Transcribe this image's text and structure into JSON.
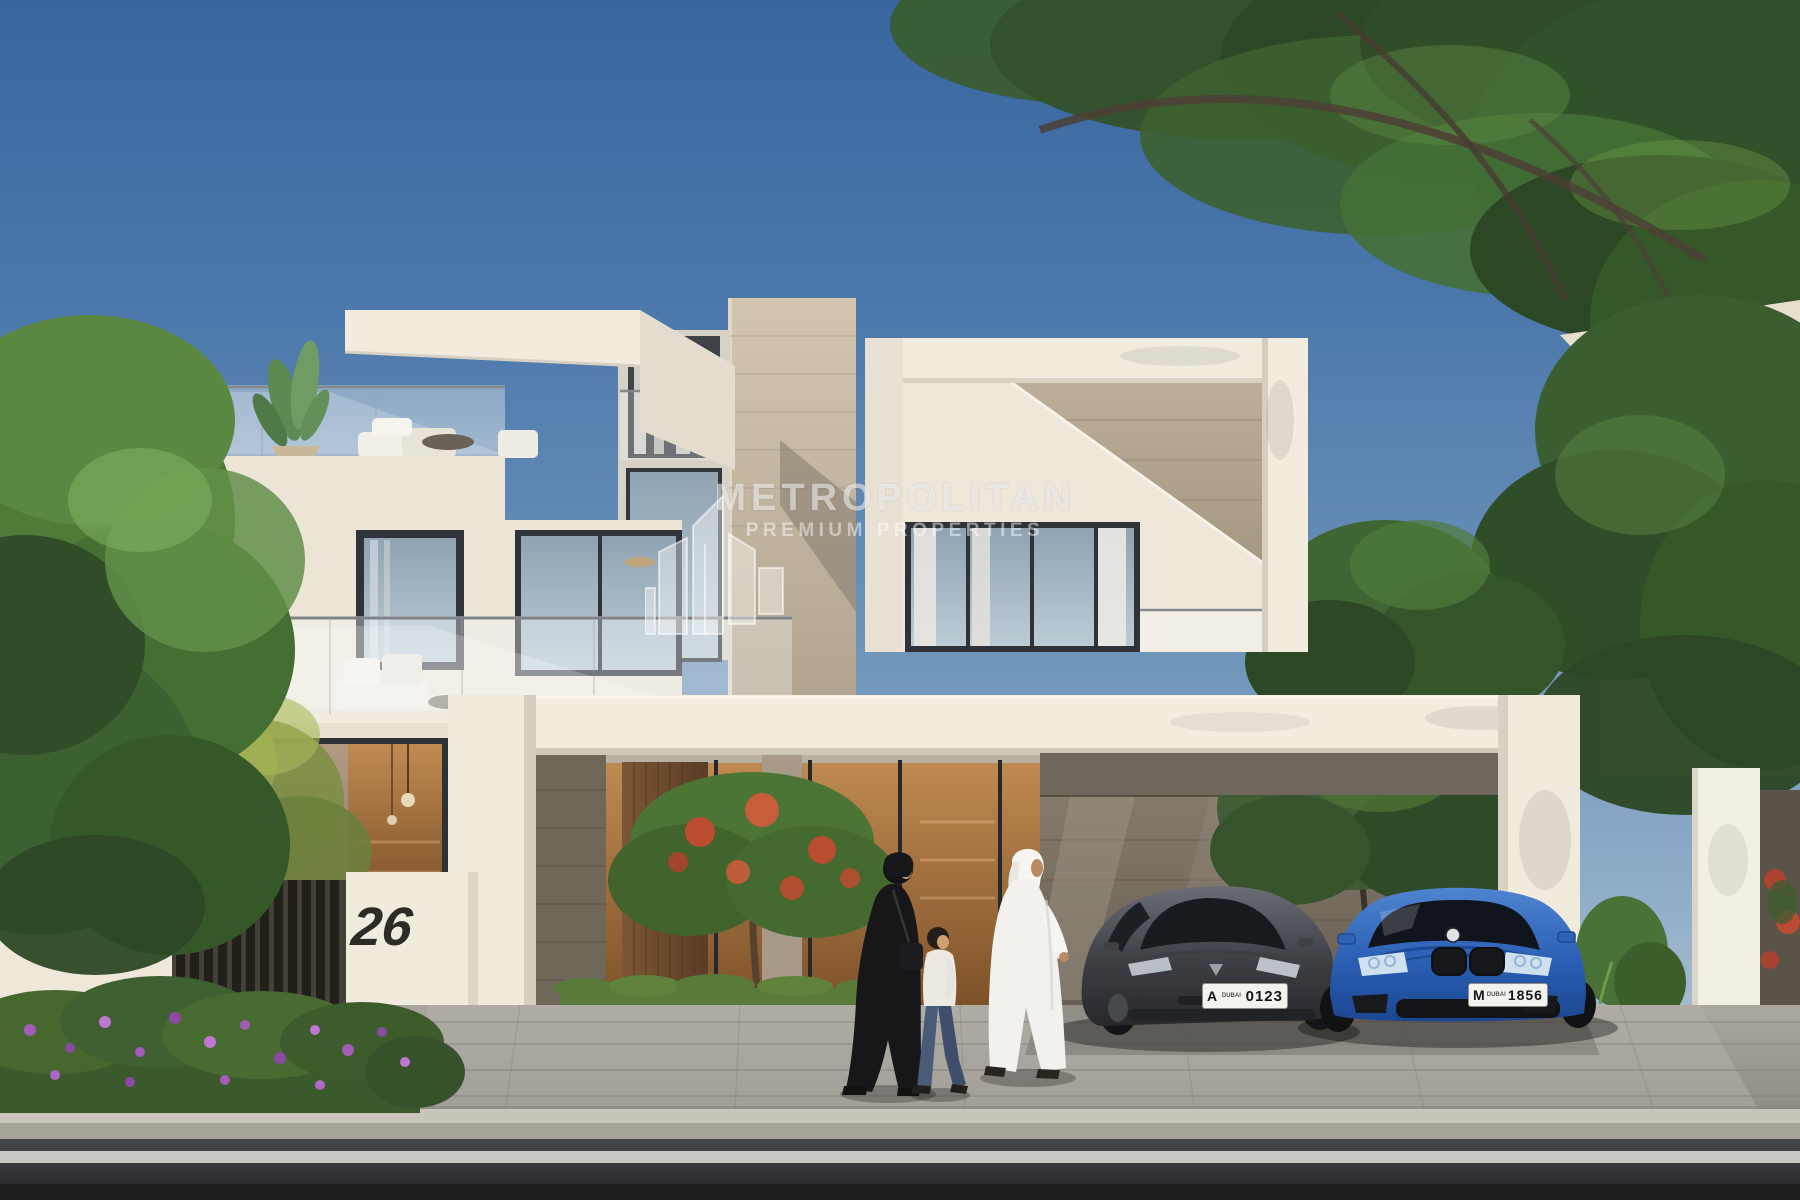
{
  "scene": {
    "description": "Daytime architectural rendering of a modern two-storey white villa with carport, seen from the street",
    "people": {
      "woman": "woman in black abaya with shoulder bag",
      "child": "boy in white shirt and blue jeans",
      "man": "man in white kandura and ghutra"
    }
  },
  "watermark": {
    "title": "METROPOLITAN",
    "subtitle": "PREMIUM PROPERTIES",
    "logo": "metropolitan-buildings-logo-icon"
  },
  "property": {
    "house_number": "26"
  },
  "vehicles": {
    "sedan_grey": {
      "label": "grey sedan",
      "plate_letter": "A",
      "plate_city": "DUBAI",
      "plate_number": "0123",
      "body_color": "#44464c"
    },
    "coupe_blue": {
      "label": "blue coupe",
      "plate_letter": "M",
      "plate_city": "DUBAI",
      "plate_number": "1856",
      "body_color": "#2e63b5"
    }
  },
  "colors": {
    "sky_top": "#39669f",
    "sky_horizon": "#b3c5d3",
    "villa_white_sunlit": "#f2ecdf",
    "villa_white_shade": "#cfc8ba",
    "travertine_stone": "#c4b7a1",
    "dark_stone_cladding": "#6f675a",
    "foliage_dark": "#2f4d27",
    "foliage_light": "#5f8a42",
    "flower_purple": "#a35cb8",
    "flower_red": "#c64a32",
    "warm_interior": "#b5834e",
    "paver_grey": "#a6a39c",
    "road_asphalt": "#2a2b2e"
  }
}
